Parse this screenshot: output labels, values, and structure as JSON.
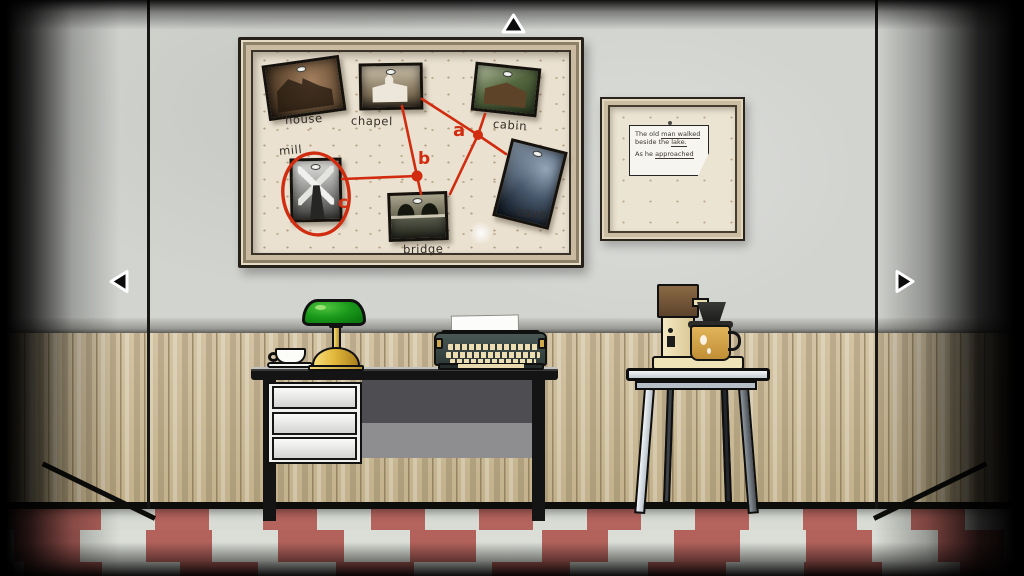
{
  "scene": {
    "title": "Detective office room"
  },
  "nav": {
    "up_icon": "arrow-up-icon",
    "left_icon": "arrow-left-icon",
    "right_icon": "arrow-right-icon"
  },
  "evidence_board": {
    "photos": [
      {
        "label": "house"
      },
      {
        "label": "chapel"
      },
      {
        "label": "cabin"
      },
      {
        "label": "mill"
      },
      {
        "label": "cave"
      },
      {
        "label": "bridge"
      }
    ],
    "markers": {
      "a": "a",
      "b": "b",
      "c": "c"
    }
  },
  "wall_note": {
    "line1_plain": "The old ",
    "line1_underlined": "man walked",
    "line2_plain": "beside the ",
    "line2_underlined": "lake.",
    "line3_plain": "As he ",
    "line3_underlined": "approached"
  },
  "colors": {
    "ink_red": "#d12c10",
    "wall_grey": "#d2d4d0",
    "wood_panel": "#c7b692",
    "floor_red": "#b4635d",
    "floor_white": "#d8dcd5",
    "board_surface": "#eae1d0",
    "lamp_green": "#1b9a1b",
    "brass_gold": "#e3b93c",
    "table_blue": "#c3ccd4"
  }
}
